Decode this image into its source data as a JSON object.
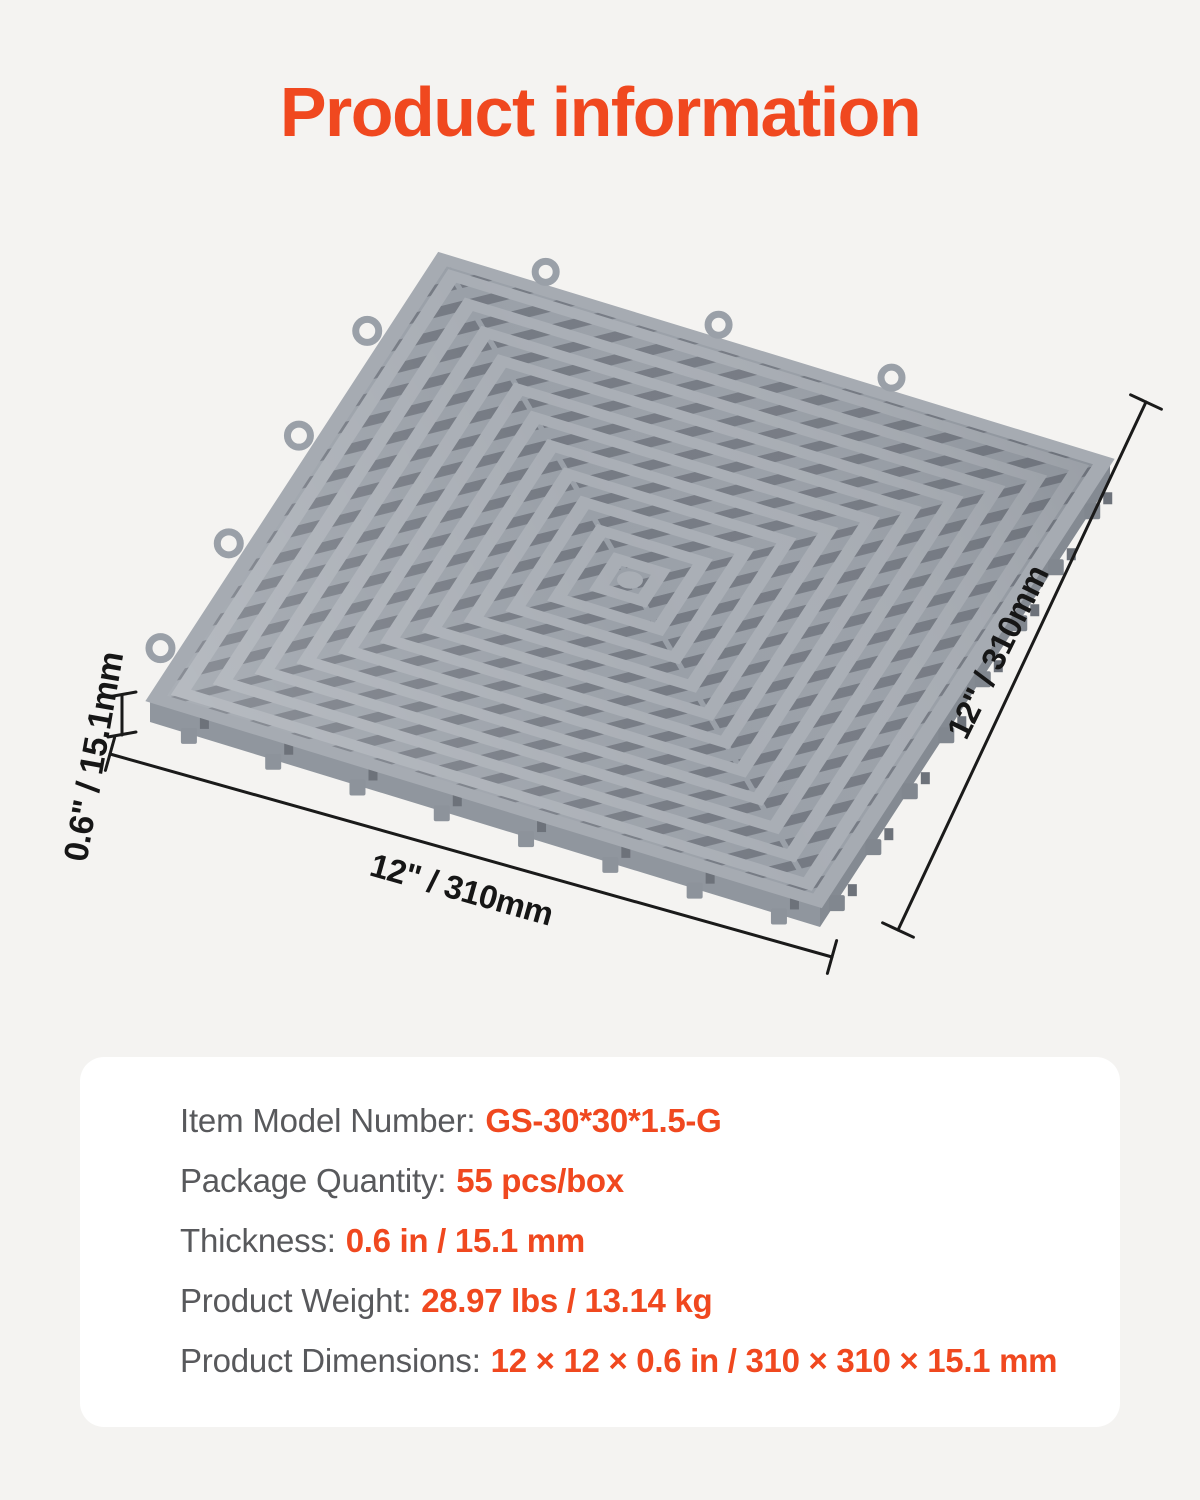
{
  "title": "Product information",
  "colors": {
    "accent_orange": "#f0481f",
    "page_background": "#f4f3f1",
    "card_background": "#ffffff",
    "dimension_line": "#1a1a1a",
    "label_gray": "#58595c",
    "tile_rib_light": "#a9aeb5",
    "tile_slat_mid": "#9aa0a8",
    "tile_gap_dark": "#757a83"
  },
  "diagram": {
    "side_dimension": "12\" / 310mm",
    "bottom_dimension": "12\" / 310mm",
    "thickness_dimension": "0.6\" / 15.1mm"
  },
  "specs": {
    "rows": [
      {
        "label": "Item Model Number:",
        "value": "GS-30*30*1.5-G"
      },
      {
        "label": "Package Quantity:",
        "value": "55 pcs/box"
      },
      {
        "label": "Thickness:",
        "value": "0.6 in / 15.1 mm"
      },
      {
        "label": "Product Weight:",
        "value": "28.97 lbs / 13.14 kg"
      },
      {
        "label": "Product Dimensions:",
        "value": "12 × 12 × 0.6 in / 310 × 310 × 15.1 mm"
      }
    ]
  }
}
